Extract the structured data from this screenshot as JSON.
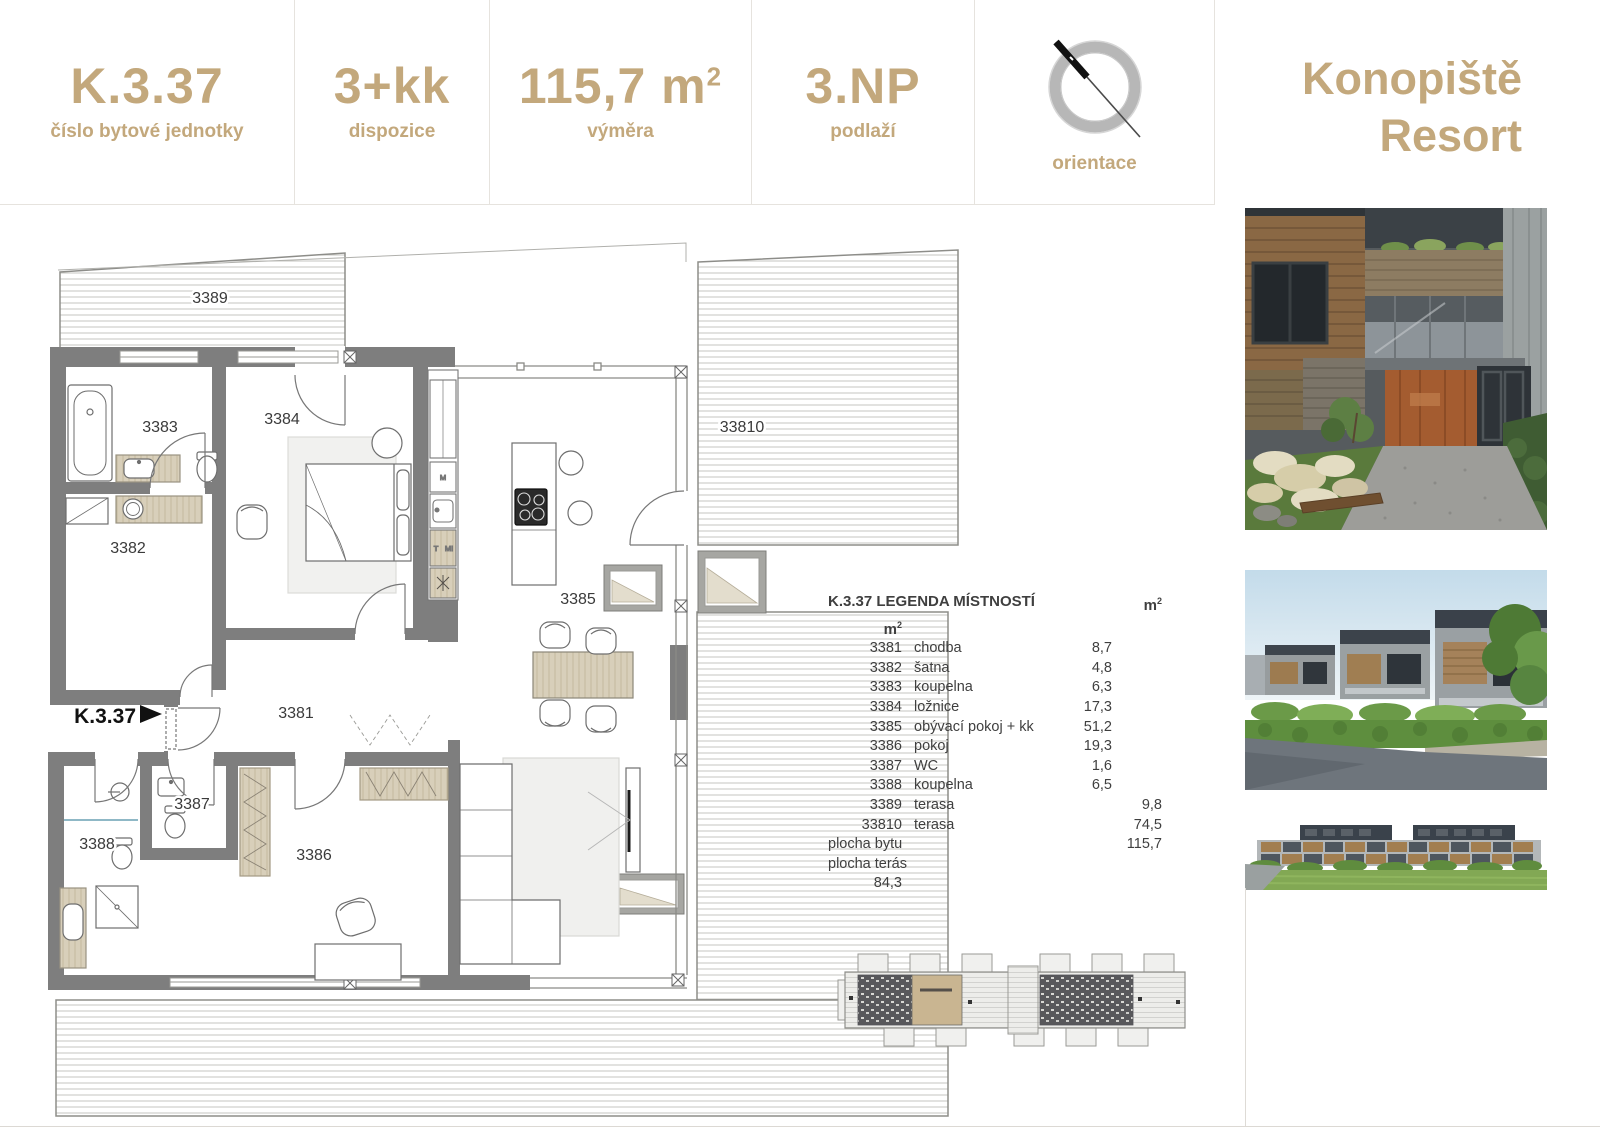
{
  "colors": {
    "accent": "#c3a87c",
    "wall_gray": "#7e7e7e",
    "furniture_tan": "#d8cfba",
    "divider_line": "#e6e3de",
    "plan_text": "#3a3a3a"
  },
  "header": {
    "cells": [
      {
        "value": "K.3.37",
        "label": "číslo bytové jednotky"
      },
      {
        "value": "3+kk",
        "label": "dispozice"
      },
      {
        "value": "115,7 m",
        "value_sup": "2",
        "label": "výměra"
      },
      {
        "value": "3.NP",
        "label": "podlaží"
      },
      {
        "value": "",
        "label": "orientace",
        "icon": "compass-icon"
      }
    ]
  },
  "brand": {
    "line1": "Konopiště",
    "line2": "Resort"
  },
  "plan": {
    "entrance_label": "K.3.37",
    "rooms": [
      "3389",
      "3383",
      "3384",
      "3382",
      "3385",
      "33810",
      "3381",
      "3387",
      "3388",
      "3386"
    ],
    "appliances": {
      "m": "M",
      "t": "T",
      "mi": "MI"
    }
  },
  "legend": {
    "title": "K.3.37 LEGENDA MÍSTNOSTÍ",
    "unit": "m",
    "unit_sup": "2",
    "rows": [
      {
        "no": "3381",
        "name": "chodba",
        "a1": "8,7",
        "a2": ""
      },
      {
        "no": "3382",
        "name": "šatna",
        "a1": "4,8",
        "a2": ""
      },
      {
        "no": "3383",
        "name": "koupelna",
        "a1": "6,3",
        "a2": ""
      },
      {
        "no": "3384",
        "name": "ložnice",
        "a1": "17,3",
        "a2": ""
      },
      {
        "no": "3385",
        "name": "obývací pokoj + kk",
        "a1": "51,2",
        "a2": ""
      },
      {
        "no": "3386",
        "name": "pokoj",
        "a1": "19,3",
        "a2": ""
      },
      {
        "no": "3387",
        "name": "WC",
        "a1": "1,6",
        "a2": ""
      },
      {
        "no": "3388",
        "name": "koupelna",
        "a1": "6,5",
        "a2": ""
      },
      {
        "no": "3389",
        "name": "terasa",
        "a1": "",
        "a2": "9,8"
      },
      {
        "no": "33810",
        "name": "terasa",
        "a1": "",
        "a2": "74,5"
      }
    ],
    "totals": [
      {
        "label": "plocha bytu",
        "a1": "115,7",
        "a2": ""
      },
      {
        "label": "plocha terás",
        "a1": "",
        "a2": "84,3"
      }
    ]
  }
}
